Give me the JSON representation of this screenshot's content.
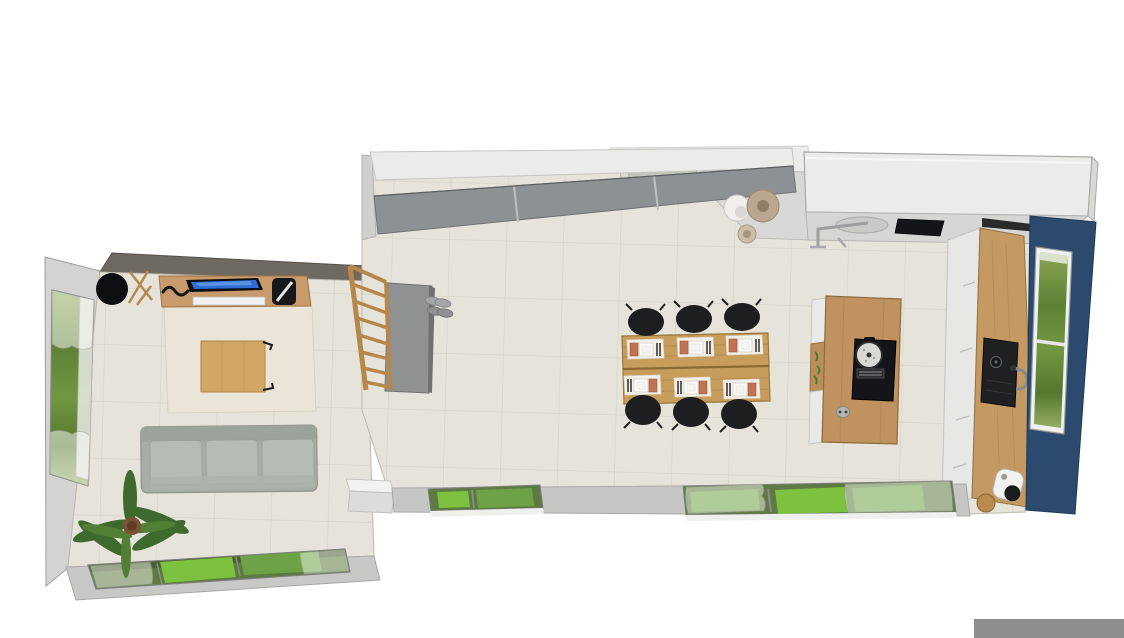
{
  "canvas": {
    "width": 1124,
    "height": 638,
    "background": "#ffffff"
  },
  "palette": {
    "floor_tile": "#e6e3db",
    "tile_line": "#d5d2c7",
    "wall_light": "#d3d3d1",
    "wall_dark": "#6e6961",
    "terrace_gray": "#c8c8c6",
    "accent_navy": "#2b4a6e",
    "wood_sideboard": "#c89a6c",
    "wood_table": "#c79d5c",
    "wood_island": "#bf9260",
    "wood_counter": "#c49a62",
    "wood_coffee_table": "#d2a765",
    "wood_railing": "#b5884a",
    "sofa_gray": "#a8ada6",
    "cushion_gray": "#b6bbb4",
    "rug_cream": "#eae5d6",
    "chair_black": "#1d1e20",
    "cabinet_gray": "#8e9194",
    "stair_gray": "#8f9192",
    "white_cabinet": "#ebebe9",
    "counter_gray": "#d6d6d4",
    "grass_bright": "#7cc23f",
    "grass_mid": "#6da346",
    "window_green_base": "#5d7a42",
    "napkin_orange": "#c07352",
    "tv_blue": "#2e6fd6",
    "sink_black": "#1f2022",
    "hob_black": "#141518",
    "bench_white": "#f2f2f0",
    "shoe_gray": "#a3a5a7",
    "plant_green": "#4d7a33",
    "vase_white": "#f0efeb",
    "vase_beige": "#b9a791",
    "cropped_object_gray": "#8d8d8d"
  },
  "scene": {
    "type": "3d-floorplan-top-down-render",
    "rooms": [
      {
        "name": "living-room",
        "items": [
          "round-black-chair",
          "wooden-chair-frame",
          "wood-sideboard",
          "flat-tv",
          "decor-squiggle",
          "black-speaker",
          "cream-rug",
          "wood-coffee-table",
          "gray-three-seat-sofa",
          "palm-plant",
          "left-wall-window",
          "garden-window-band"
        ]
      },
      {
        "name": "kitchen-dining-room",
        "items": [
          "sliding-door-wardrobe",
          "doorway",
          "decor-vases",
          "tall-white-cabinet-block",
          "wall-counter-with-sink",
          "wall-cooktop",
          "staircase",
          "shoes",
          "dining-table",
          "dining-chairs",
          "place-settings",
          "kitchen-island",
          "island-cooktop",
          "cooking-pot",
          "island-socket",
          "island-open-shelf",
          "right-wood-counter",
          "black-sink",
          "coffee-machine",
          "navy-accent-wall",
          "navy-wall-window",
          "garden-window-a",
          "garden-window-b",
          "white-bench"
        ],
        "dining_chairs_count": 6,
        "place_settings_count": 6
      }
    ]
  }
}
